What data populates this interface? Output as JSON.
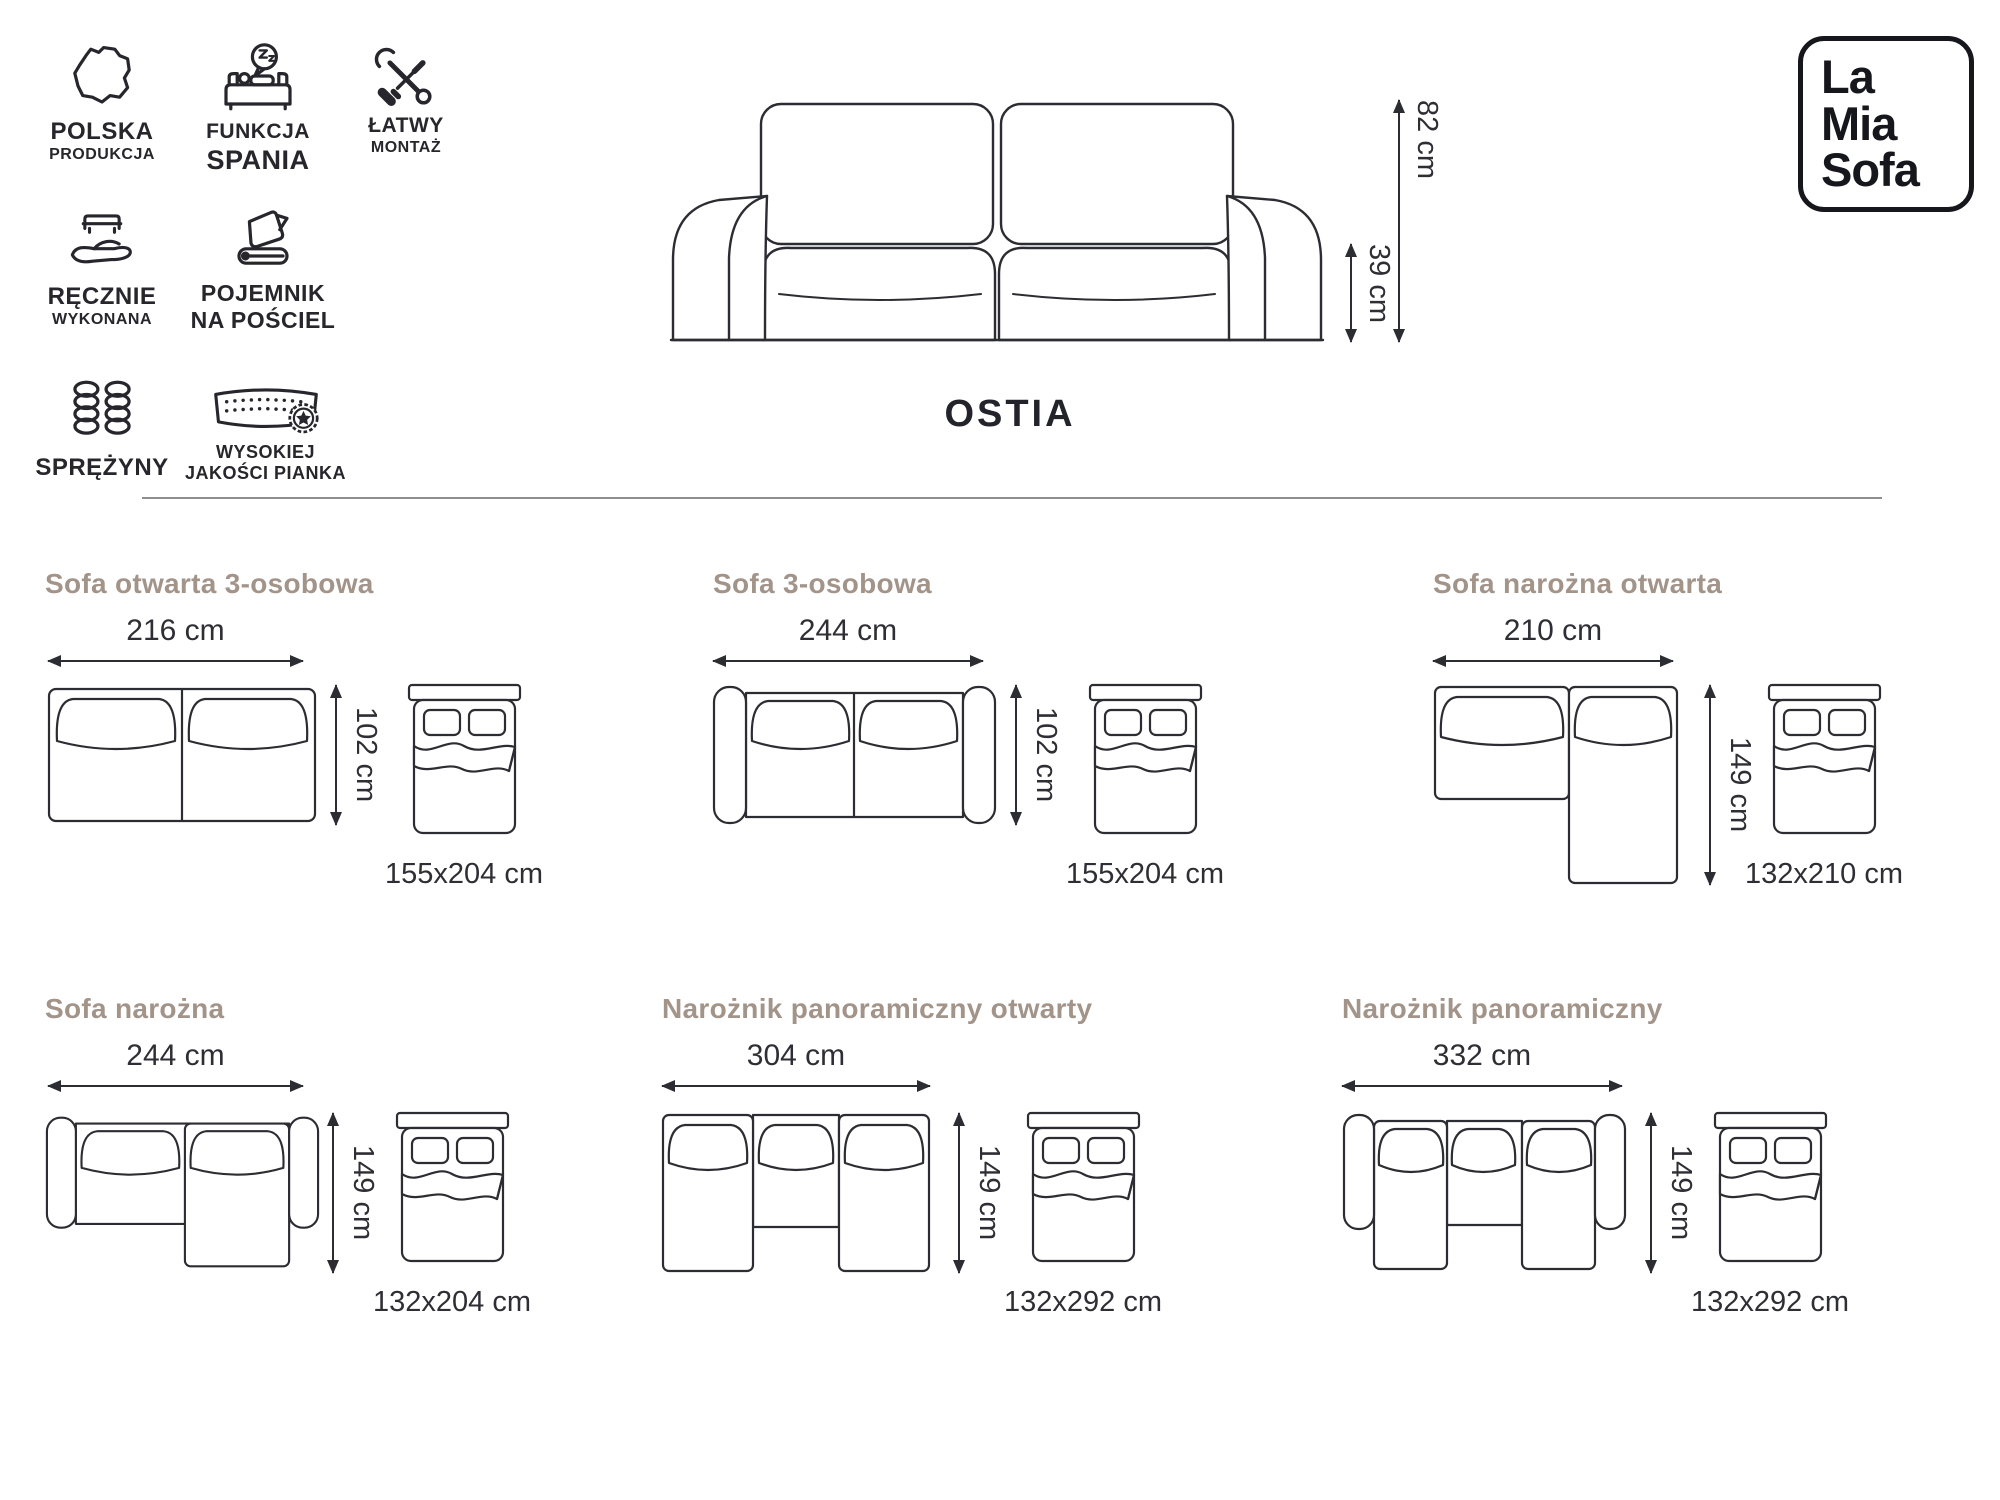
{
  "brand": {
    "name": "La Mia Sofa",
    "logo": {
      "line1": "La",
      "line2": "Mia",
      "line3": "Sofa"
    }
  },
  "product": {
    "title": "OSTIA"
  },
  "main_dimensions": {
    "height": "82 cm",
    "seat_height": "39 cm"
  },
  "features": [
    {
      "icon": "poland-map-icon",
      "label": "POLSKA",
      "sublabel": "PRODUKCJA"
    },
    {
      "icon": "sleep-function-icon",
      "label": "FUNKCJA",
      "sublabel": "SPANIA"
    },
    {
      "icon": "tools-icon",
      "label": "ŁATWY",
      "sublabel": "MONTAŻ"
    },
    {
      "icon": "hand-made-icon",
      "label": "RĘCZNIE",
      "sublabel": "WYKONANA"
    },
    {
      "icon": "bedding-container-icon",
      "label": "POJEMNIK",
      "sublabel": "NA POŚCIEL"
    },
    {
      "icon": "springs-icon",
      "label": "SPRĘŻYNY",
      "sublabel": ""
    },
    {
      "icon": "foam-quality-icon",
      "label": "WYSOKIEJ",
      "sublabel": "JAKOŚCI PIANKA"
    }
  ],
  "variants": [
    {
      "title": "Sofa otwarta 3-osobowa",
      "width": "216 cm",
      "depth": "102 cm",
      "bed_size": "155x204 cm"
    },
    {
      "title": "Sofa 3-osobowa",
      "width": "244 cm",
      "depth": "102 cm",
      "bed_size": "155x204 cm"
    },
    {
      "title": "Sofa narożna otwarta",
      "width": "210 cm",
      "depth": "149 cm",
      "bed_size": "132x210 cm"
    },
    {
      "title": "Sofa narożna",
      "width": "244 cm",
      "depth": "149 cm",
      "bed_size": "132x204 cm"
    },
    {
      "title": "Narożnik panoramiczny otwarty",
      "width": "304 cm",
      "depth": "149 cm",
      "bed_size": "132x292 cm"
    },
    {
      "title": "Narożnik panoramiczny",
      "width": "332 cm",
      "depth": "149 cm",
      "bed_size": "132x292 cm"
    }
  ],
  "colors": {
    "line": "#2c2c33",
    "text": "#2e2e35",
    "heading": "#a3948a",
    "divider": "#8f8f8f"
  }
}
